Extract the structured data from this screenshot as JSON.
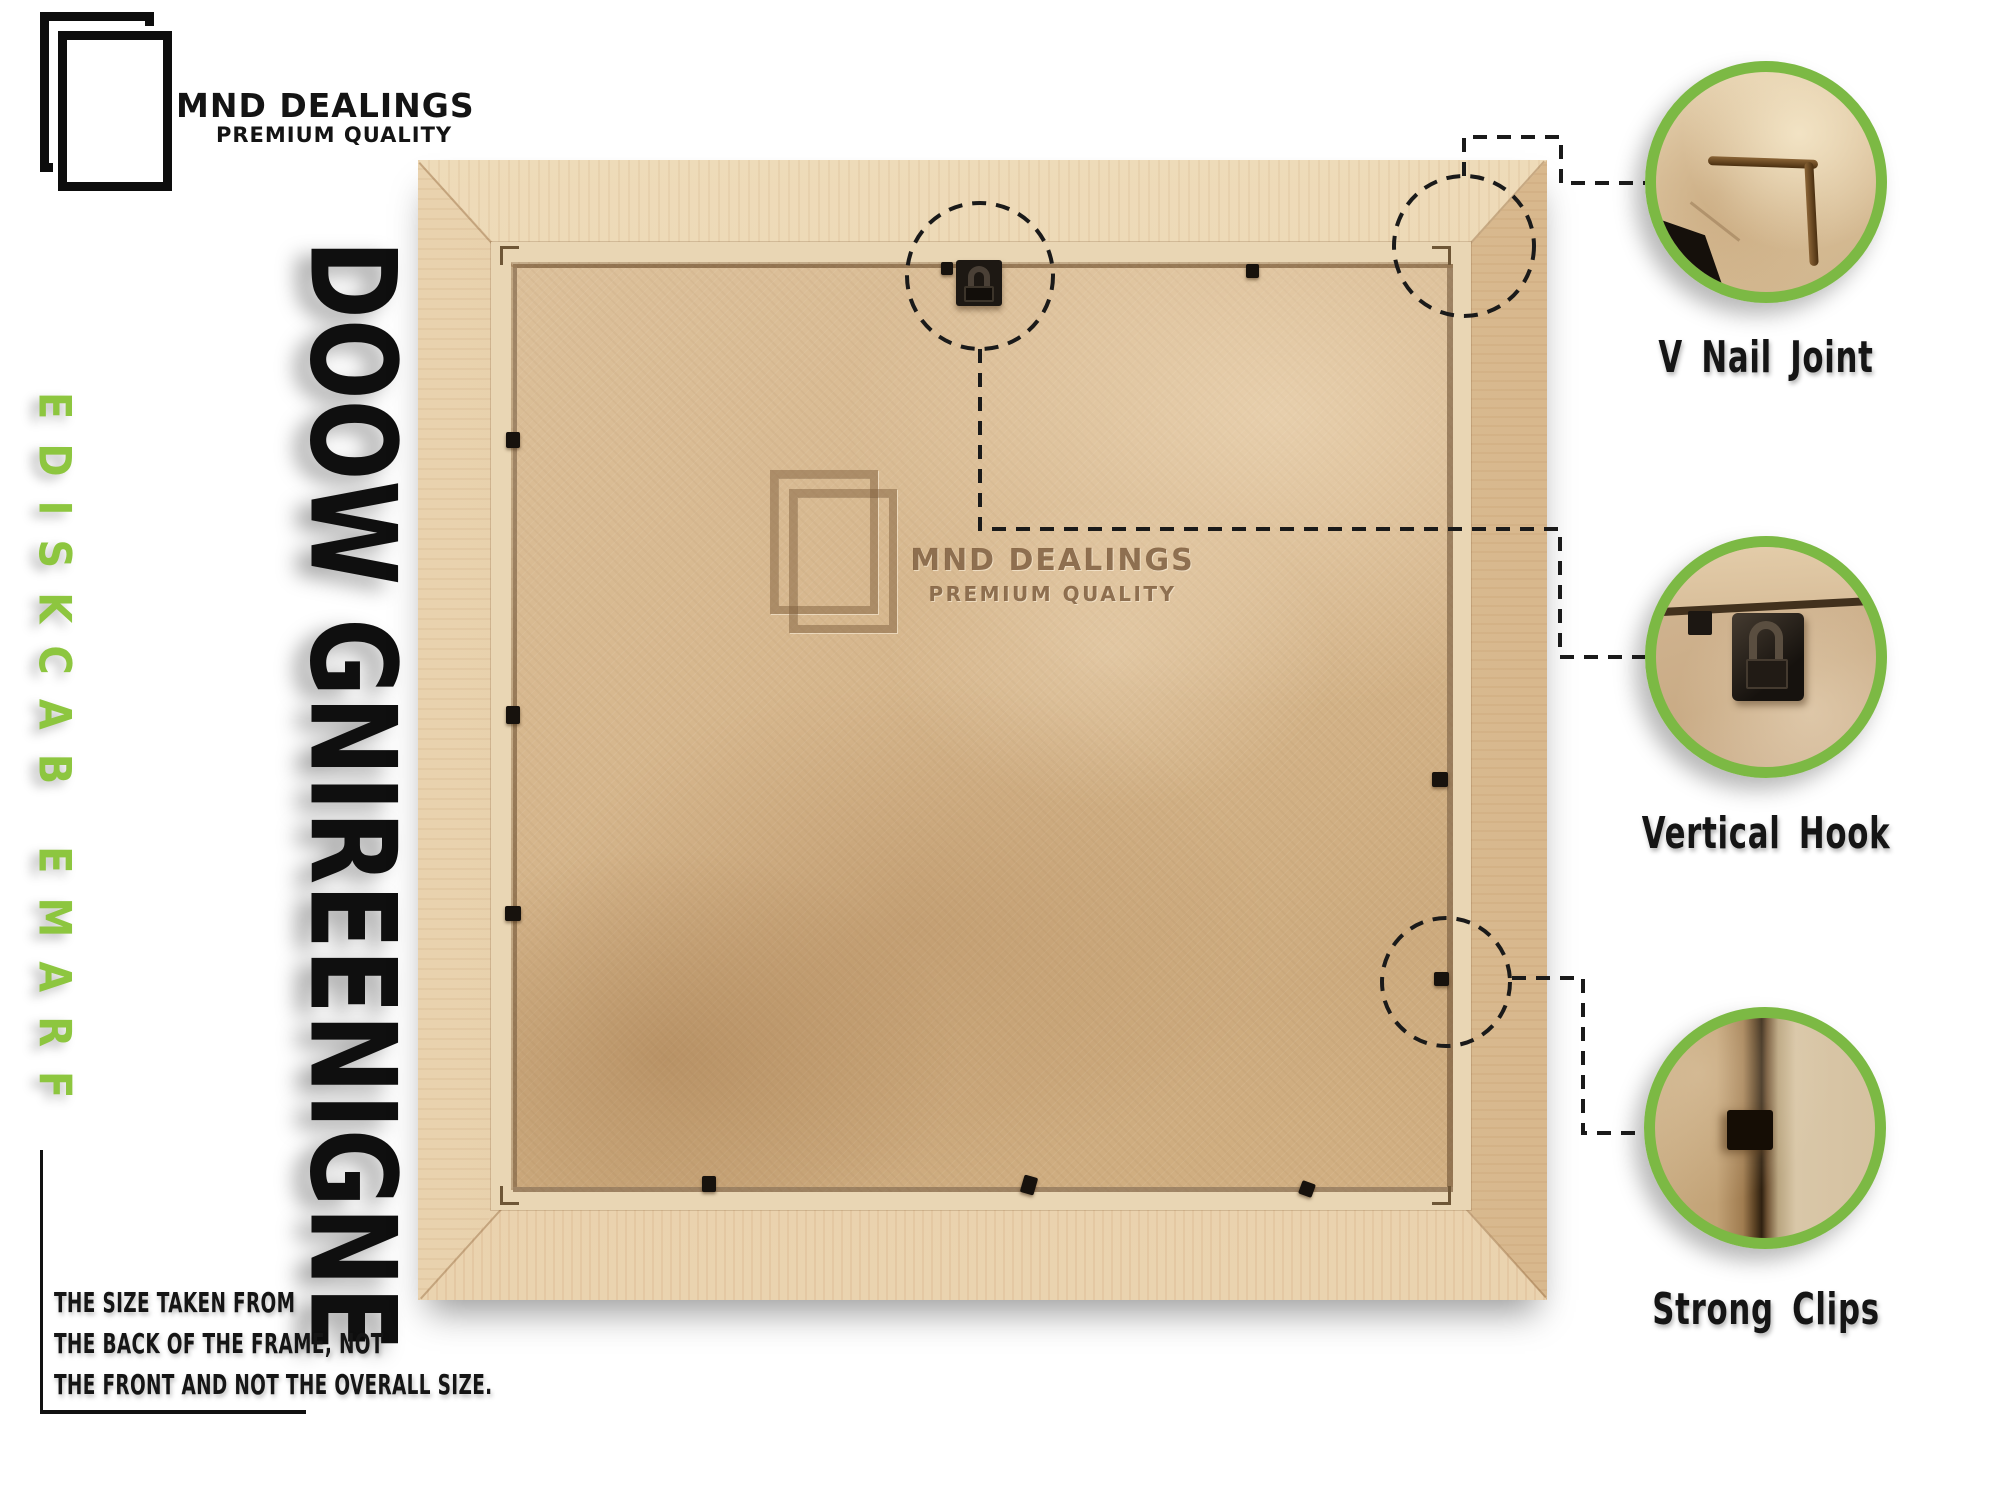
{
  "brand": {
    "name": "MND DEALINGS",
    "tagline": "PREMIUM QUALITY"
  },
  "side_label": "FRAME BACKSIDE",
  "material_label": "ENGINEERING WOOD",
  "watermark": {
    "name": "MND DEALINGS",
    "tagline": "PREMIUM QUALITY"
  },
  "size_note": {
    "line1": "THE SIZE TAKEN FROM",
    "line2": "THE BACK OF THE FRAME, NOT",
    "line3": "THE FRONT AND NOT THE OVERALL SIZE."
  },
  "callouts": [
    {
      "label": "V Nail Joint"
    },
    {
      "label": "Vertical Hook"
    },
    {
      "label": "Strong Clips"
    }
  ],
  "colors": {
    "accent_green": "#7cb944",
    "green_text": "#8dc63f",
    "text_black": "#141414",
    "frame_wood": "#e5cba6",
    "backboard_kraft": "#d6b68c"
  }
}
